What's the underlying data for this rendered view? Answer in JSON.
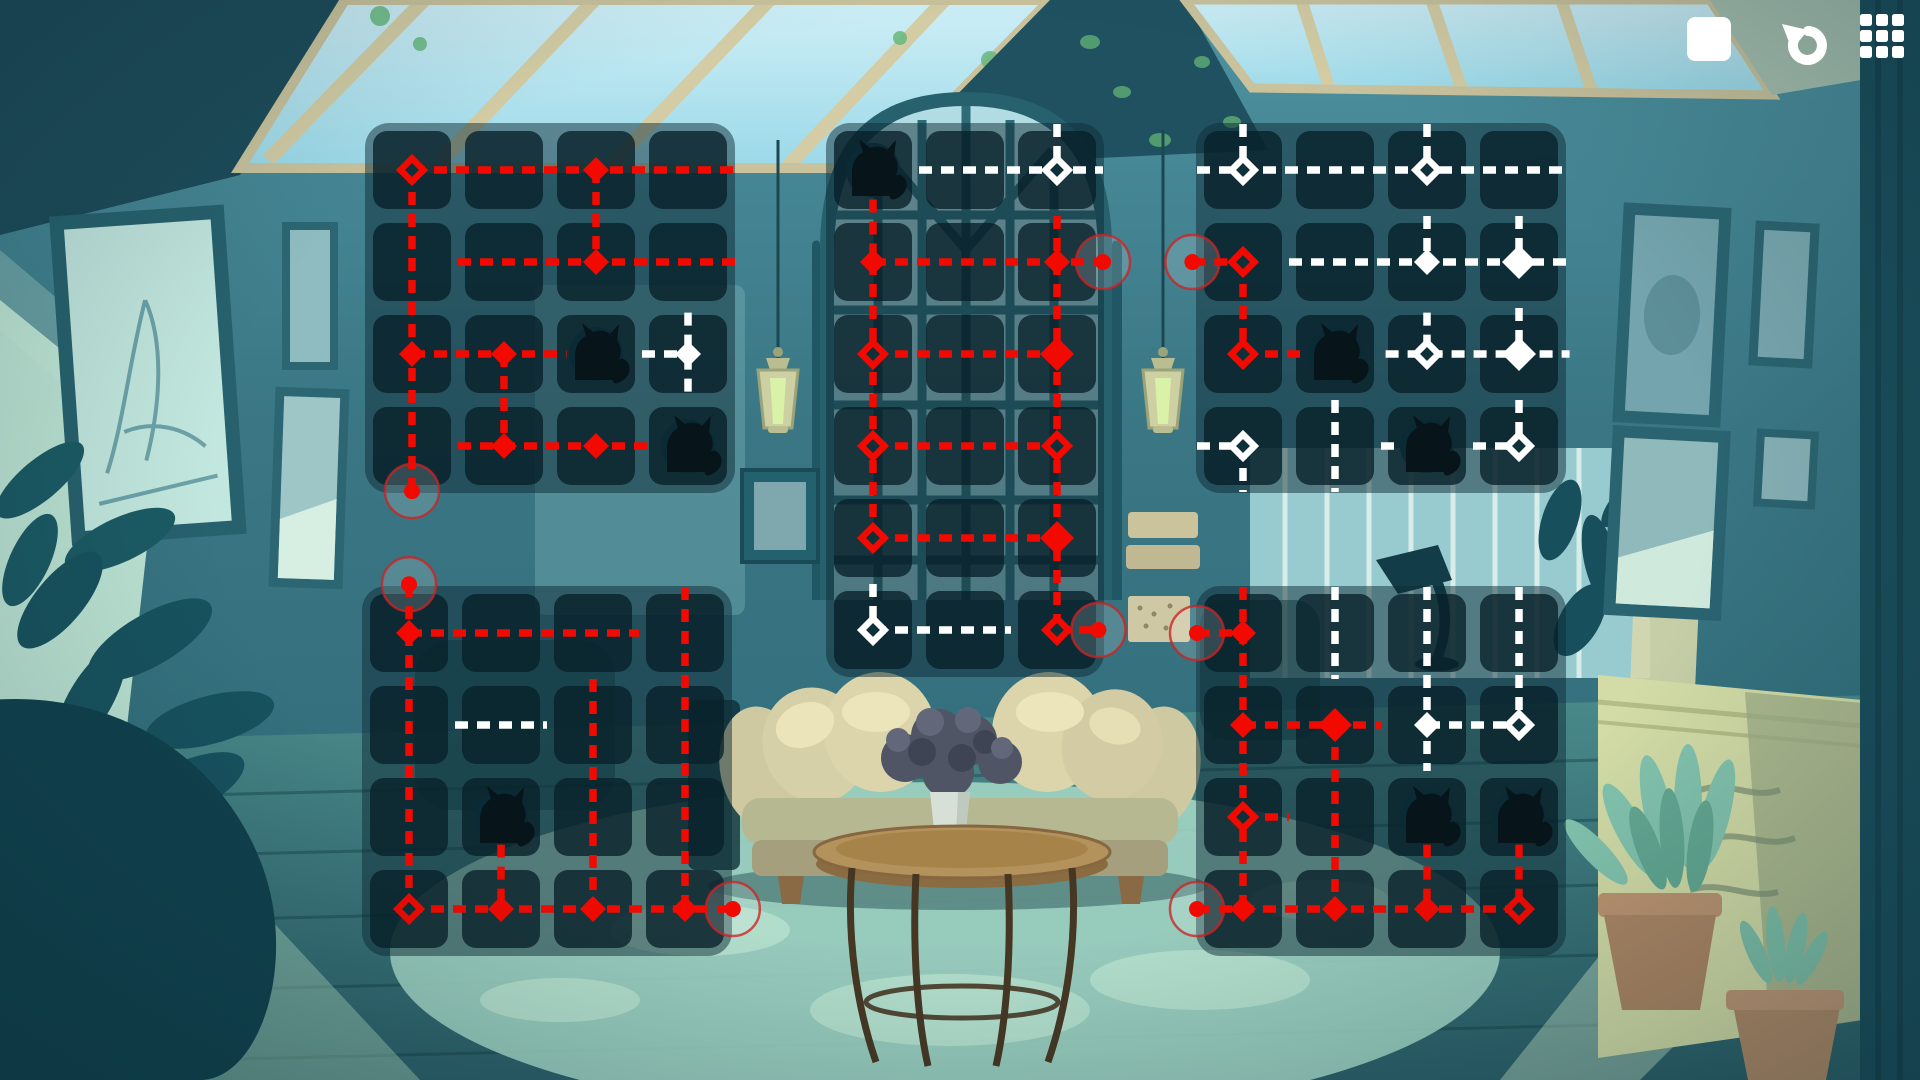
{
  "screen": {
    "type": "puzzle-level-screen",
    "theme": "cozy teal living room with skylights"
  },
  "toolbar": {
    "buttons": [
      {
        "id": "stop",
        "icon": "stop-square-icon"
      },
      {
        "id": "undo",
        "icon": "undo-arrow-icon"
      },
      {
        "id": "menu",
        "icon": "grid-menu-icon"
      }
    ]
  },
  "palette": {
    "path_red": "#f20a00",
    "path_white": "#ffffff",
    "ring_stroke": "rgba(205,35,35,0.78)",
    "ring_fill": "rgba(255,255,255,0.16)",
    "node_hole": "#0e3039",
    "panel": "rgba(14,43,53,0.50)",
    "cell": "rgba(8,32,41,0.78)",
    "cat": "#071419",
    "cat_disc": "rgba(11,42,54,0.95)"
  },
  "board": {
    "cell_size": 78,
    "cell_gap": 14,
    "pad": 8,
    "cat_path": "M -21 26 L -21 2 C -21 -7 -17 -14 -10 -18 L -14 -31 L -3 -22 C 3 -24 9 -24 14 -20 L 23 -30 L 21 -14 C 25 -8 26 -1 23 5 C 28 10 29 18 25 26 Z",
    "cat_tail": "M 20 26 C 31 22 33 12 26 8",
    "grids": [
      {
        "id": 1,
        "x": 365,
        "y": 123,
        "cols": 4,
        "rows": 4,
        "segments": [
          [
            "r",
            1,
            1,
            4.53,
            1
          ],
          [
            "r",
            1,
            1,
            1,
            4.49
          ],
          [
            "r",
            3,
            1,
            3,
            2
          ],
          [
            "r",
            1.5,
            2,
            4.53,
            2
          ],
          [
            "r",
            1,
            3,
            2.68,
            3
          ],
          [
            "r",
            2,
            3,
            2,
            4
          ],
          [
            "r",
            1.5,
            4,
            3.63,
            4
          ],
          [
            "w",
            4,
            2.55,
            4,
            3.5
          ],
          [
            "w",
            3.5,
            3,
            4,
            3
          ]
        ],
        "nodes": [
          [
            "r",
            "open",
            1,
            1
          ],
          [
            "r",
            "fill",
            3,
            1
          ],
          [
            "r",
            "fill",
            3,
            2
          ],
          [
            "r",
            "fill",
            1,
            3
          ],
          [
            "r",
            "fill",
            2,
            3
          ],
          [
            "r",
            "fill",
            2,
            4
          ],
          [
            "r",
            "fill",
            3,
            4
          ],
          [
            "w",
            "fill",
            4,
            3
          ]
        ],
        "endpoints": [
          [
            1,
            4.49
          ]
        ],
        "cats": [
          [
            3,
            3
          ],
          [
            4,
            4
          ]
        ]
      },
      {
        "id": 2,
        "x": 826,
        "y": 123,
        "cols": 3,
        "rows": 6,
        "segments": [
          [
            "w",
            3,
            0.5,
            3,
            1
          ],
          [
            "w",
            1.5,
            1,
            3.5,
            1
          ],
          [
            "r",
            1,
            1.32,
            1,
            2
          ],
          [
            "r",
            1,
            2,
            3.5,
            2
          ],
          [
            "r",
            3,
            1.5,
            3,
            2
          ],
          [
            "r",
            1,
            2,
            1,
            5
          ],
          [
            "r",
            3,
            2,
            3,
            6
          ],
          [
            "r",
            1,
            3,
            3,
            3
          ],
          [
            "r",
            1,
            4,
            3,
            4
          ],
          [
            "r",
            1,
            5,
            3,
            5
          ],
          [
            "r",
            3,
            6,
            3.45,
            6
          ],
          [
            "w",
            1,
            5.5,
            1,
            6
          ],
          [
            "w",
            1,
            6,
            2.5,
            6
          ]
        ],
        "nodes": [
          [
            "w",
            "open",
            3,
            1
          ],
          [
            "r",
            "fill",
            1,
            2
          ],
          [
            "r",
            "fill",
            3,
            2
          ],
          [
            "r",
            "open",
            1,
            3
          ],
          [
            "r",
            "big",
            3,
            3
          ],
          [
            "r",
            "open",
            1,
            4
          ],
          [
            "r",
            "open",
            3,
            4
          ],
          [
            "r",
            "open",
            1,
            5
          ],
          [
            "r",
            "big",
            3,
            5
          ],
          [
            "r",
            "open",
            3,
            6
          ],
          [
            "w",
            "open",
            1,
            6
          ]
        ],
        "endpoints": [
          [
            3.5,
            2
          ],
          [
            3.45,
            6
          ]
        ],
        "cats": [
          [
            1,
            1
          ]
        ]
      },
      {
        "id": 3,
        "x": 1196,
        "y": 123,
        "cols": 4,
        "rows": 4,
        "segments": [
          [
            "w",
            1,
            0.5,
            1,
            1
          ],
          [
            "w",
            0.5,
            1,
            4.55,
            1
          ],
          [
            "w",
            3,
            0.5,
            3,
            1
          ],
          [
            "w",
            1.5,
            2,
            4.55,
            2
          ],
          [
            "w",
            3,
            1.5,
            3,
            2
          ],
          [
            "w",
            4,
            1.5,
            4,
            2
          ],
          [
            "w",
            3,
            2.55,
            3,
            3
          ],
          [
            "w",
            4,
            2.5,
            4,
            3
          ],
          [
            "w",
            2.55,
            3,
            4.55,
            3
          ],
          [
            "w",
            0.5,
            4,
            1,
            4
          ],
          [
            "w",
            1,
            4,
            1,
            4.5
          ],
          [
            "w",
            2,
            3.5,
            2,
            4.5
          ],
          [
            "w",
            2.5,
            4,
            2.72,
            4
          ],
          [
            "w",
            3.5,
            4,
            4,
            4
          ],
          [
            "w",
            4,
            3.5,
            4,
            4
          ],
          [
            "r",
            0.45,
            2,
            1,
            2
          ],
          [
            "r",
            1,
            2,
            1,
            3
          ],
          [
            "r",
            1,
            3,
            1.72,
            3
          ]
        ],
        "nodes": [
          [
            "w",
            "open",
            1,
            1
          ],
          [
            "w",
            "open",
            3,
            1
          ],
          [
            "w",
            "fill",
            3,
            2
          ],
          [
            "w",
            "big",
            4,
            2
          ],
          [
            "w",
            "open",
            3,
            3
          ],
          [
            "w",
            "big",
            4,
            3
          ],
          [
            "w",
            "open",
            1,
            4
          ],
          [
            "w",
            "open",
            4,
            4
          ],
          [
            "r",
            "open",
            1,
            2
          ],
          [
            "r",
            "open",
            1,
            3
          ]
        ],
        "endpoints": [
          [
            0.45,
            2
          ]
        ],
        "cats": [
          [
            2,
            3
          ],
          [
            3,
            4
          ]
        ]
      },
      {
        "id": 4,
        "x": 362,
        "y": 586,
        "cols": 4,
        "rows": 4,
        "segments": [
          [
            "r",
            1,
            0.47,
            1,
            1
          ],
          [
            "r",
            1,
            1,
            3.5,
            1
          ],
          [
            "r",
            1,
            1,
            1,
            4
          ],
          [
            "r",
            4,
            0.5,
            4,
            4
          ],
          [
            "r",
            3,
            1.5,
            3,
            4
          ],
          [
            "r",
            2,
            3.3,
            2,
            4
          ],
          [
            "r",
            1,
            4,
            4.52,
            4
          ],
          [
            "w",
            1.5,
            2,
            2.5,
            2
          ]
        ],
        "nodes": [
          [
            "r",
            "fill",
            1,
            1
          ],
          [
            "r",
            "open",
            1,
            4
          ],
          [
            "r",
            "fill",
            2,
            4
          ],
          [
            "r",
            "fill",
            3,
            4
          ],
          [
            "r",
            "fill",
            4,
            4
          ]
        ],
        "endpoints": [
          [
            1,
            0.47
          ],
          [
            4.52,
            4
          ]
        ],
        "cats": [
          [
            2,
            3
          ]
        ]
      },
      {
        "id": 5,
        "x": 1196,
        "y": 586,
        "cols": 4,
        "rows": 4,
        "segments": [
          [
            "r",
            0.5,
            1,
            1,
            1
          ],
          [
            "r",
            1,
            0.5,
            1,
            4
          ],
          [
            "r",
            1,
            2,
            2.5,
            2
          ],
          [
            "r",
            2,
            2,
            2,
            4
          ],
          [
            "r",
            1,
            3,
            1.5,
            3
          ],
          [
            "r",
            3,
            3.3,
            3,
            4
          ],
          [
            "r",
            4,
            3.3,
            4,
            4
          ],
          [
            "r",
            0.5,
            4,
            4,
            4
          ],
          [
            "w",
            2,
            0.5,
            2,
            1.5
          ],
          [
            "w",
            3,
            0.5,
            3,
            2.5
          ],
          [
            "w",
            3,
            2,
            4,
            2
          ],
          [
            "w",
            4,
            0.5,
            4,
            2
          ]
        ],
        "nodes": [
          [
            "r",
            "fill",
            1,
            1
          ],
          [
            "r",
            "fill",
            1,
            2
          ],
          [
            "r",
            "big",
            2,
            2
          ],
          [
            "r",
            "open",
            1,
            3
          ],
          [
            "r",
            "fill",
            1,
            4
          ],
          [
            "r",
            "fill",
            2,
            4
          ],
          [
            "r",
            "fill",
            3,
            4
          ],
          [
            "r",
            "open",
            4,
            4
          ],
          [
            "w",
            "fill",
            3,
            2
          ],
          [
            "w",
            "open",
            4,
            2
          ]
        ],
        "endpoints": [
          [
            0.5,
            1
          ],
          [
            0.5,
            4
          ]
        ],
        "cats": [
          [
            3,
            3
          ],
          [
            4,
            3
          ]
        ]
      }
    ]
  }
}
